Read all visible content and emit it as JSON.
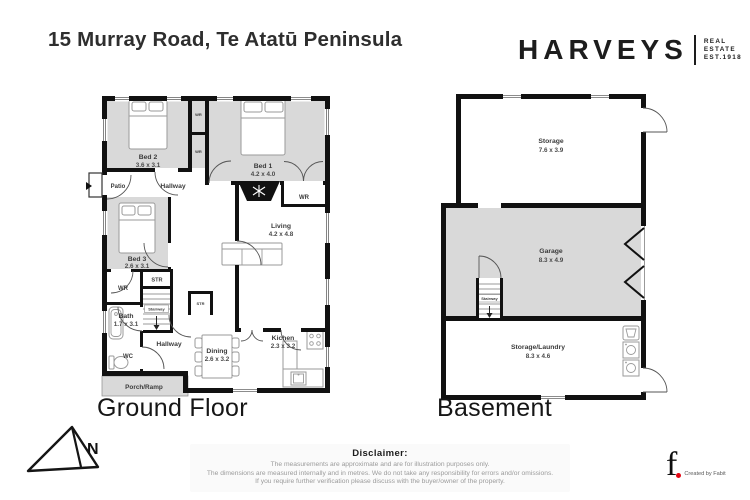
{
  "header": {
    "title": "15 Murray Road, Te Atatū Peninsula",
    "brand": {
      "name": "HARVEYS",
      "sub1": "REAL",
      "sub2": "ESTATE",
      "sub3": "EST.1918"
    }
  },
  "ground_floor": {
    "name": "Ground Floor",
    "rooms": {
      "bed2": {
        "label": "Bed 2",
        "dims": "3.6 x 3.1"
      },
      "bed1": {
        "label": "Bed 1",
        "dims": "4.2 x 4.0"
      },
      "bed3": {
        "label": "Bed 3",
        "dims": "2.6 x 3.1"
      },
      "living": {
        "label": "Living",
        "dims": "4.2 x 4.8"
      },
      "dining": {
        "label": "Dining",
        "dims": "2.6 x 3.2"
      },
      "kitchen": {
        "label": "Kichen",
        "dims": "2.3 x 3.2"
      },
      "bath": {
        "label": "Bath",
        "dims": "1.7 x 3.1"
      },
      "hallway_upper": {
        "label": "Hallway"
      },
      "hallway_lower": {
        "label": "Hallway"
      },
      "patio": {
        "label": "Patio"
      },
      "porch": {
        "label": "Porch/Ramp"
      },
      "wc": {
        "label": "WC"
      },
      "wr_bed3": {
        "label": "WR"
      },
      "wr_bed1": {
        "label": "WR"
      },
      "wr_closet_top": {
        "label": "WR"
      },
      "wr_closet_bottom": {
        "label": "WR"
      },
      "str_stairs": {
        "label": "STR"
      },
      "str_hall": {
        "label": "STR"
      },
      "stairway": {
        "label": "Stairway"
      }
    }
  },
  "basement": {
    "name": "Basement",
    "rooms": {
      "storage": {
        "label": "Storage",
        "dims": "7.6 x 3.9"
      },
      "garage": {
        "label": "Garage",
        "dims": "8.3 x 4.9"
      },
      "storage_laundry": {
        "label": "Storage/Laundry",
        "dims": "8.3 x 4.6"
      },
      "stairway": {
        "label": "Stairway"
      }
    }
  },
  "compass": {
    "label": "N"
  },
  "disclaimer": {
    "heading": "Disclaimer:",
    "lines": [
      "The measurements are approximate and are for illustration purposes only.",
      "The dimensions are measured internally and in metres. We do not take any responsibility for errors and/or omissions.",
      "If you require further verification please discuss with the buyer/owner of the property."
    ]
  },
  "credit": {
    "letter": "f",
    "text": "Created by Fabit"
  },
  "colors": {
    "wall": "#111111",
    "room_gray": "#d9d9d9",
    "accent_red": "#e30613",
    "background": "#ffffff"
  }
}
